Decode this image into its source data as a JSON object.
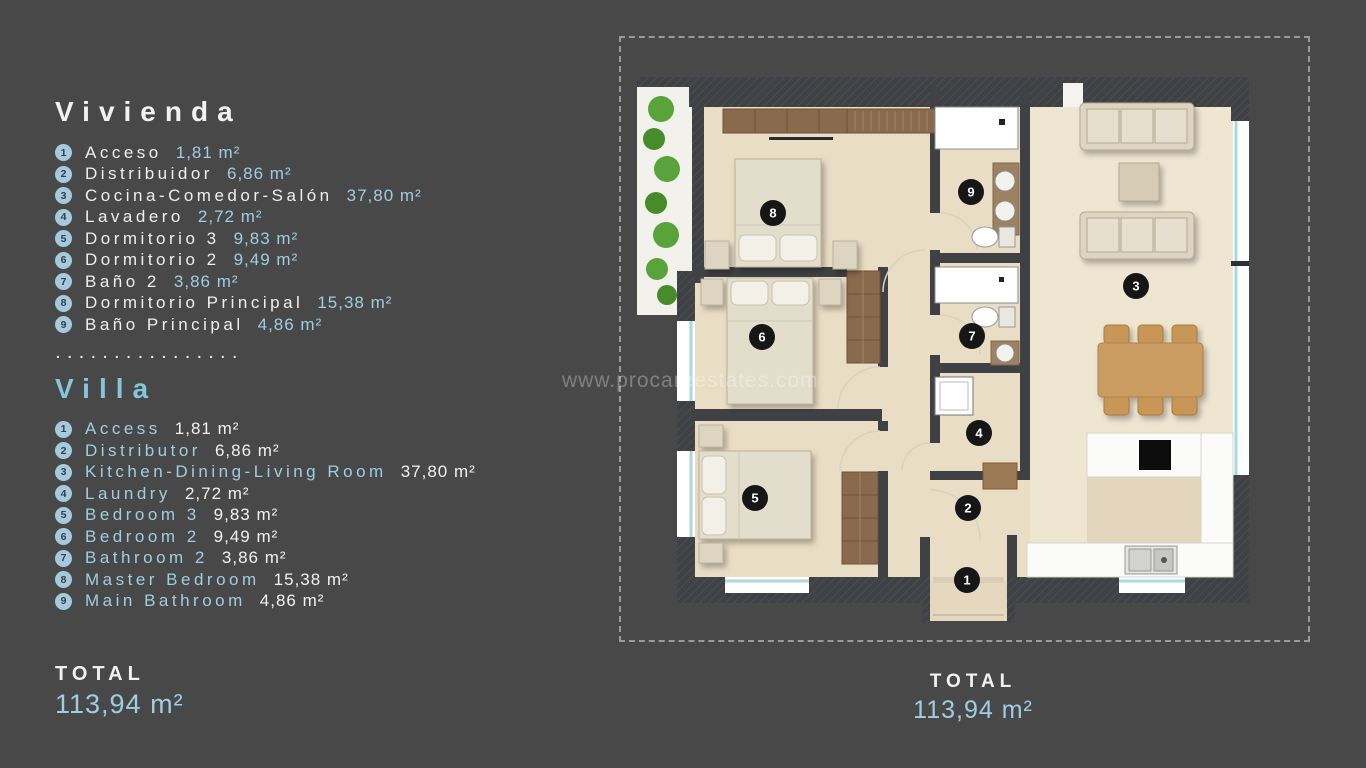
{
  "watermark": "www.procareestates.com",
  "separator_dots": ". . . . . . . . . . . . . . . .",
  "legend": {
    "vivienda": {
      "title": "Vivienda",
      "items": [
        {
          "num": "1",
          "name": "Acceso",
          "area": "1,81",
          "unit": "m²"
        },
        {
          "num": "2",
          "name": "Distribuidor",
          "area": "6,86",
          "unit": "m²"
        },
        {
          "num": "3",
          "name": "Cocina-Comedor-Salón",
          "area": "37,80",
          "unit": "m²"
        },
        {
          "num": "4",
          "name": "Lavadero",
          "area": "2,72",
          "unit": "m²"
        },
        {
          "num": "5",
          "name": "Dormitorio 3",
          "area": "9,83",
          "unit": "m²"
        },
        {
          "num": "6",
          "name": "Dormitorio 2",
          "area": "9,49",
          "unit": "m²"
        },
        {
          "num": "7",
          "name": "Baño 2",
          "area": "3,86",
          "unit": "m²"
        },
        {
          "num": "8",
          "name": "Dormitorio Principal",
          "area": "15,38",
          "unit": "m²"
        },
        {
          "num": "9",
          "name": "Baño Principal",
          "area": "4,86",
          "unit": "m²"
        }
      ]
    },
    "villa": {
      "title": "Villa",
      "items": [
        {
          "num": "1",
          "name": "Access",
          "area": "1,81",
          "unit": "m²"
        },
        {
          "num": "2",
          "name": "Distributor",
          "area": "6,86",
          "unit": "m²"
        },
        {
          "num": "3",
          "name": "Kitchen-Dining-Living Room",
          "area": "37,80",
          "unit": "m²"
        },
        {
          "num": "4",
          "name": "Laundry",
          "area": "2,72",
          "unit": "m²"
        },
        {
          "num": "5",
          "name": "Bedroom 3",
          "area": "9,83",
          "unit": "m²"
        },
        {
          "num": "6",
          "name": "Bedroom 2",
          "area": "9,49",
          "unit": "m²"
        },
        {
          "num": "7",
          "name": "Bathroom 2",
          "area": "3,86",
          "unit": "m²"
        },
        {
          "num": "8",
          "name": "Master Bedroom",
          "area": "15,38",
          "unit": "m²"
        },
        {
          "num": "9",
          "name": "Main Bathroom",
          "area": "4,86",
          "unit": "m²"
        }
      ]
    }
  },
  "totals": {
    "left": {
      "label": "TOTAL",
      "value": "113,94",
      "unit": "m²"
    },
    "right": {
      "label": "TOTAL",
      "value": "113,94",
      "unit": "m²"
    }
  },
  "plan": {
    "badges": [
      {
        "n": "1"
      },
      {
        "n": "2"
      },
      {
        "n": "3"
      },
      {
        "n": "4"
      },
      {
        "n": "5"
      },
      {
        "n": "6"
      },
      {
        "n": "7"
      },
      {
        "n": "8"
      },
      {
        "n": "9"
      }
    ]
  },
  "colors": {
    "background": "#484848",
    "accent_blue": "#9fcde2",
    "title_blue": "#85c6dd",
    "text_white": "#f2f1ef",
    "badge_legend_bg": "#a5c9de",
    "badge_plan_bg": "#161616",
    "wall": "#3f4145",
    "floor": "#eaddc5",
    "wood_brown": "#cc9d64",
    "wardrobe_brown": "#8a6a4d",
    "garden_green": "#5aa33a",
    "window_teal": "#aad8dc",
    "dashed_border": "#9a9a9a"
  }
}
